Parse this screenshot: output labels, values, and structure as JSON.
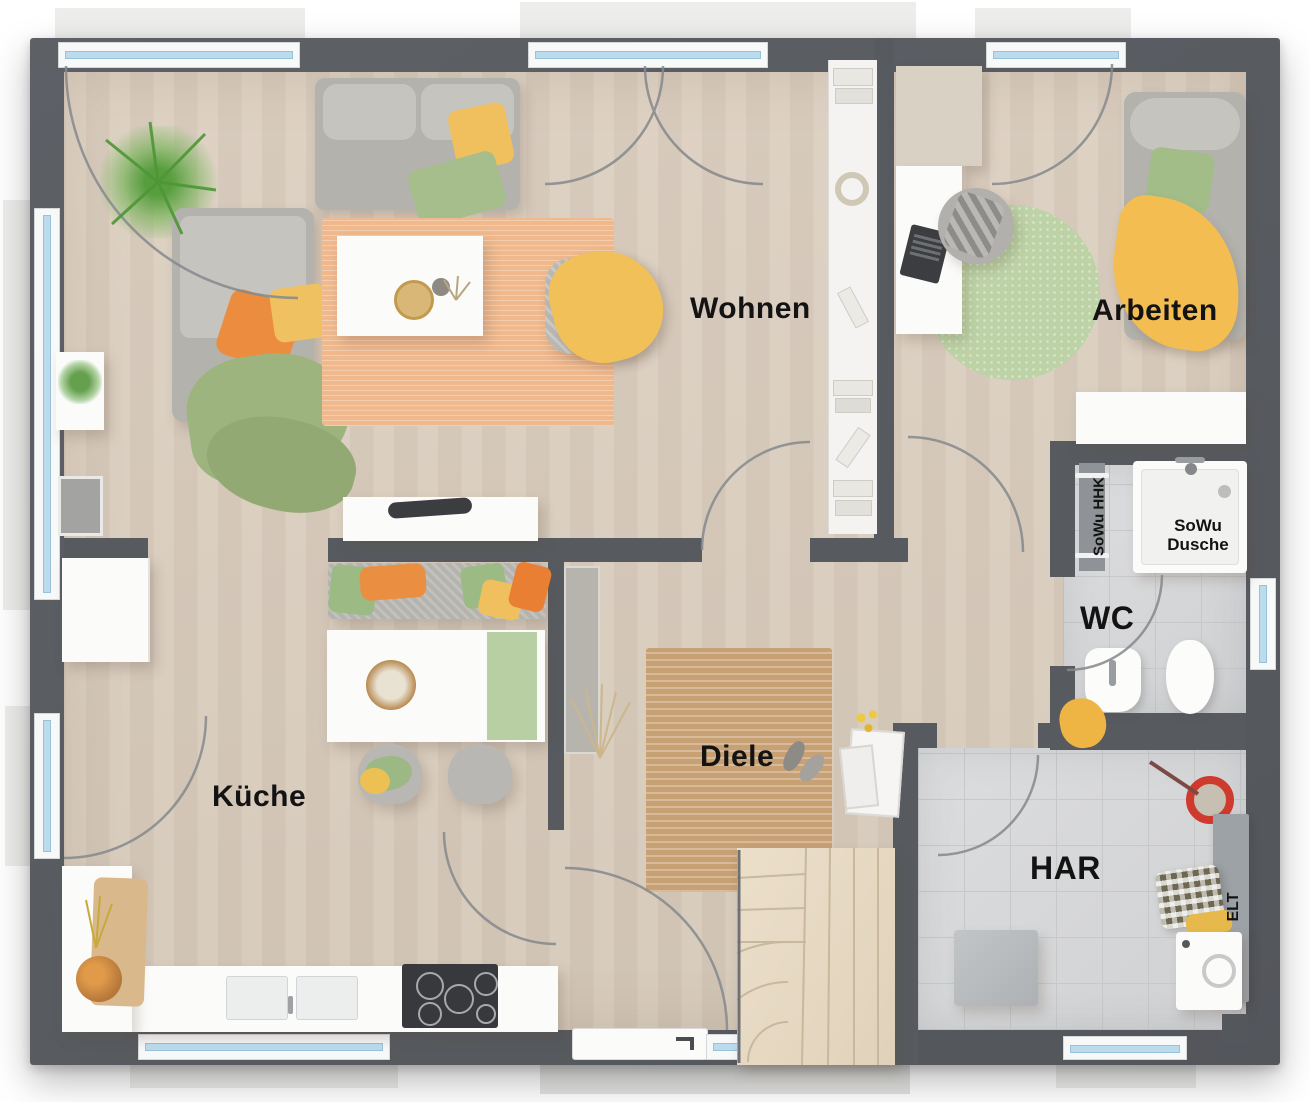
{
  "plan": {
    "type": "floor-plan",
    "language": "de",
    "rooms": [
      {
        "id": "wohnen",
        "label": "Wohnen"
      },
      {
        "id": "arbeiten",
        "label": "Arbeiten"
      },
      {
        "id": "kueche",
        "label": "Küche"
      },
      {
        "id": "diele",
        "label": "Diele"
      },
      {
        "id": "wc",
        "label": "WC"
      },
      {
        "id": "har",
        "label": "HAR"
      }
    ],
    "annotations": [
      {
        "id": "sowu-hhk",
        "label": "SoWu HHK"
      },
      {
        "id": "sowu-dusche",
        "label": "SoWu Dusche"
      },
      {
        "id": "elt",
        "label": "ELT"
      }
    ],
    "colors": {
      "wall": "#575b60",
      "wood_floor": "#d9cdbe",
      "tile_floor": "#d7d8da",
      "window_glass": "#bcdcee",
      "rug_living": "#efb88d",
      "rug_diele": "#c7a074",
      "rug_office": "#bdd3a6",
      "accent_orange": "#ea8a3e",
      "accent_yellow": "#f0bf5e",
      "accent_green": "#9fbc86",
      "mop_bucket_red": "#d23b30"
    }
  }
}
